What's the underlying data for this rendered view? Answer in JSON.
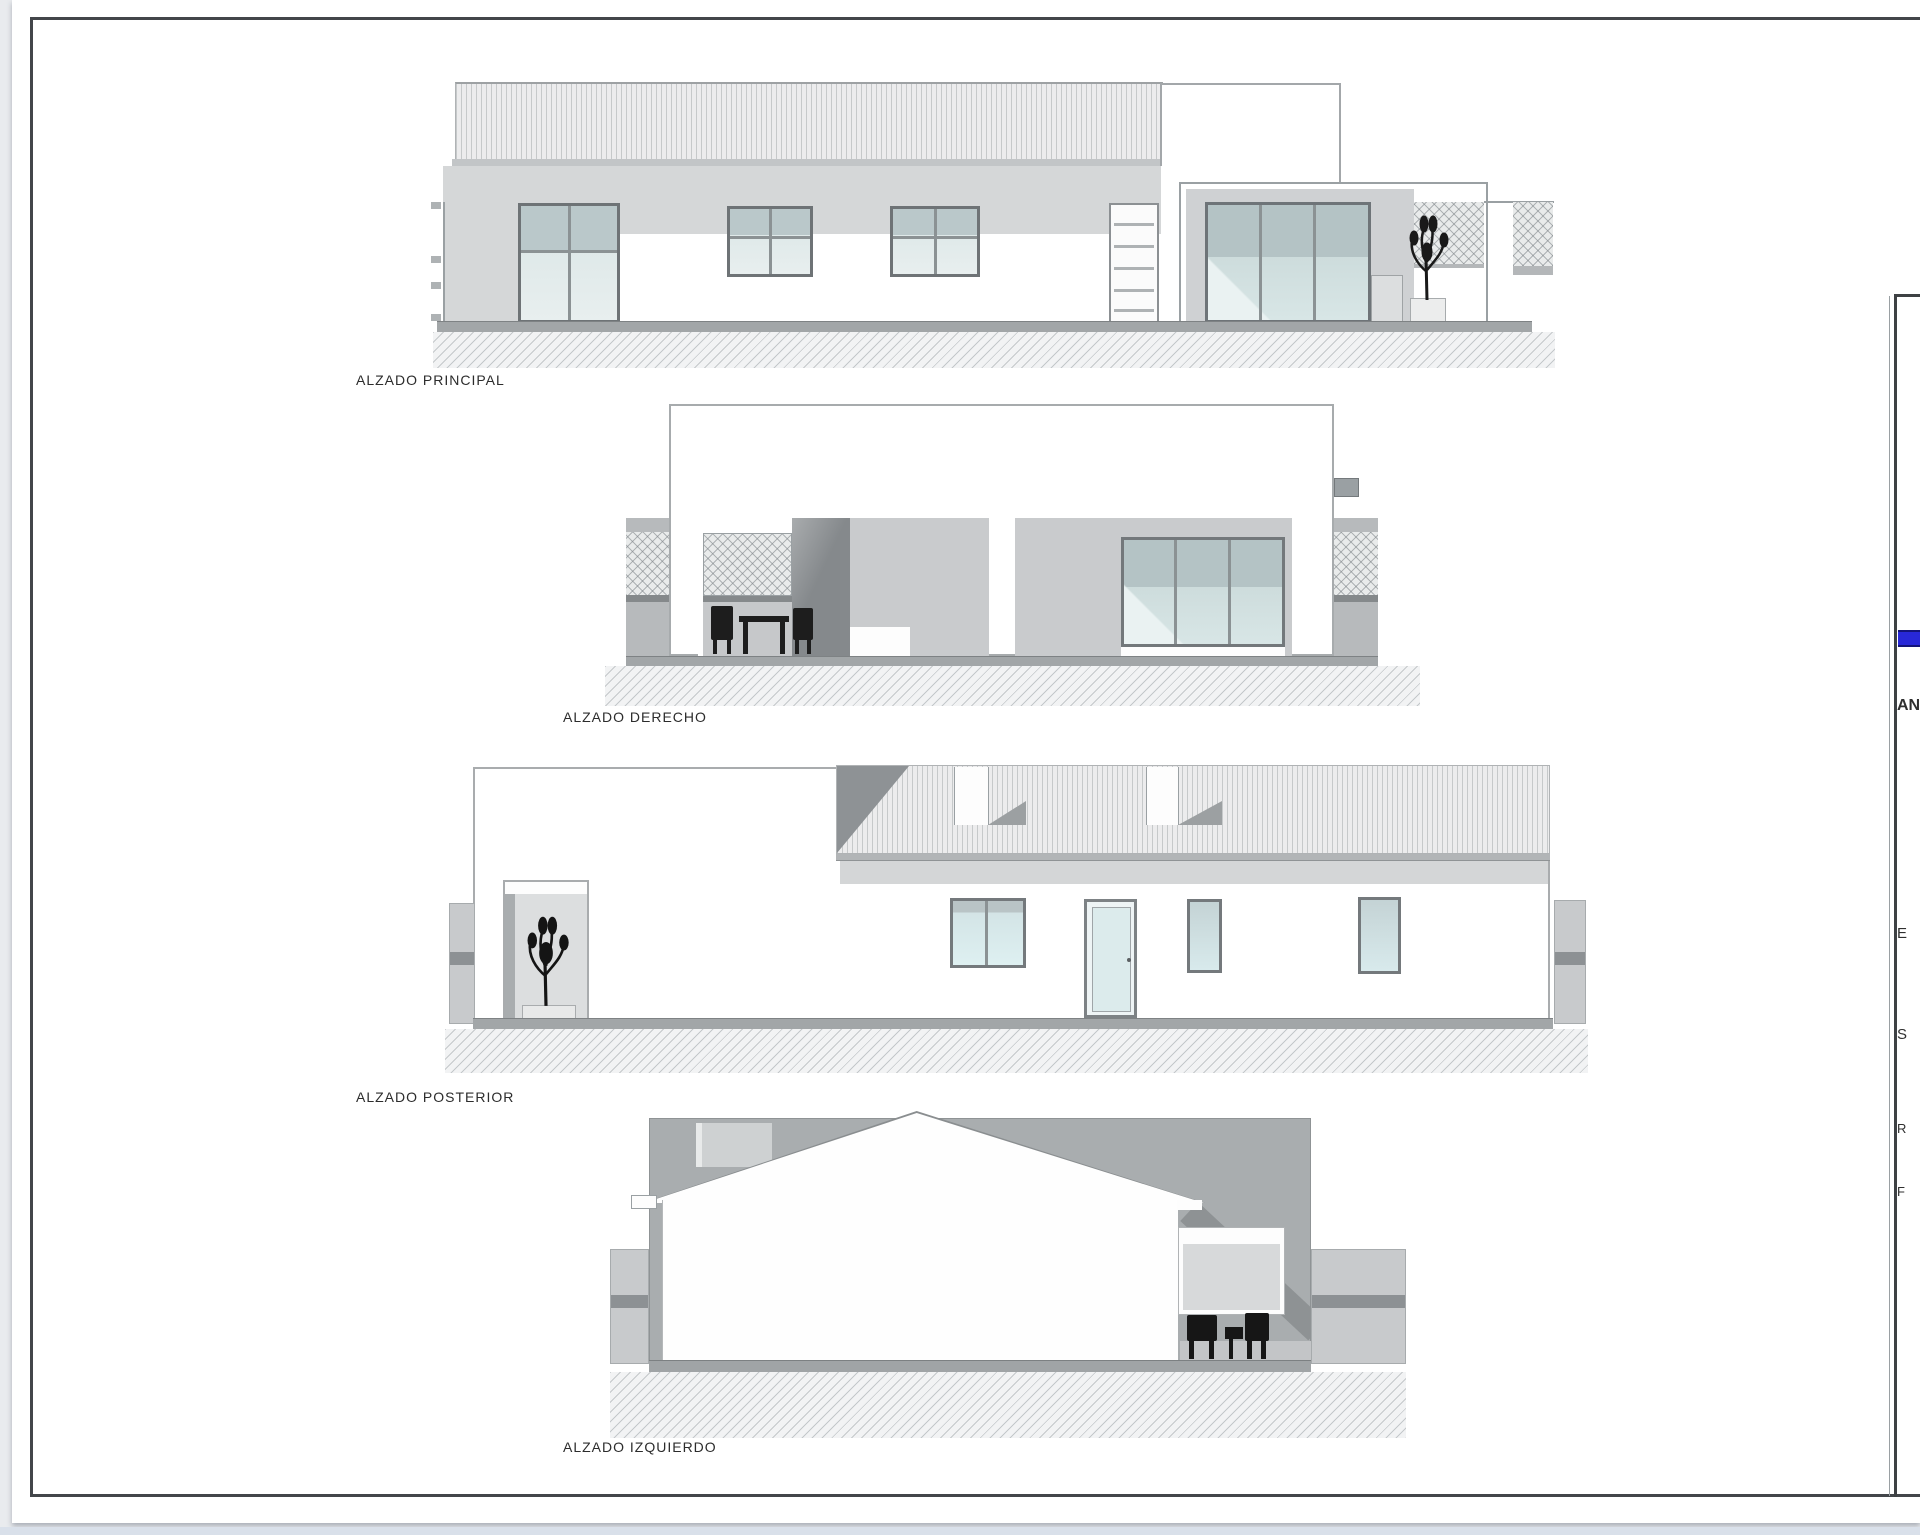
{
  "sheet": {
    "type": "architectural-elevations-sheet",
    "labels": {
      "principal": "ALZADO PRINCIPAL",
      "derecho": "ALZADO DERECHO",
      "posterior": "ALZADO POSTERIOR",
      "izquierdo": "ALZADO IZQUIERDO"
    }
  },
  "title_block": {
    "accent_color": "#2828d8",
    "fragments": {
      "f1": "AN",
      "f2": "E",
      "f3": "S",
      "f4": "R",
      "f5": "F"
    }
  },
  "palette": {
    "page_background": "#e9ebee",
    "sheet_white": "#ffffff",
    "frame": "#43464a",
    "wall_shade": "#d5d7d8",
    "mid_gray": "#c9cbcd",
    "backdrop_gray": "#a9adaf",
    "dark_gray": "#8e9295",
    "glass_top": "#bac8ca",
    "glass_bottom": "#e0eaea",
    "ground": "#a2a6a8"
  }
}
